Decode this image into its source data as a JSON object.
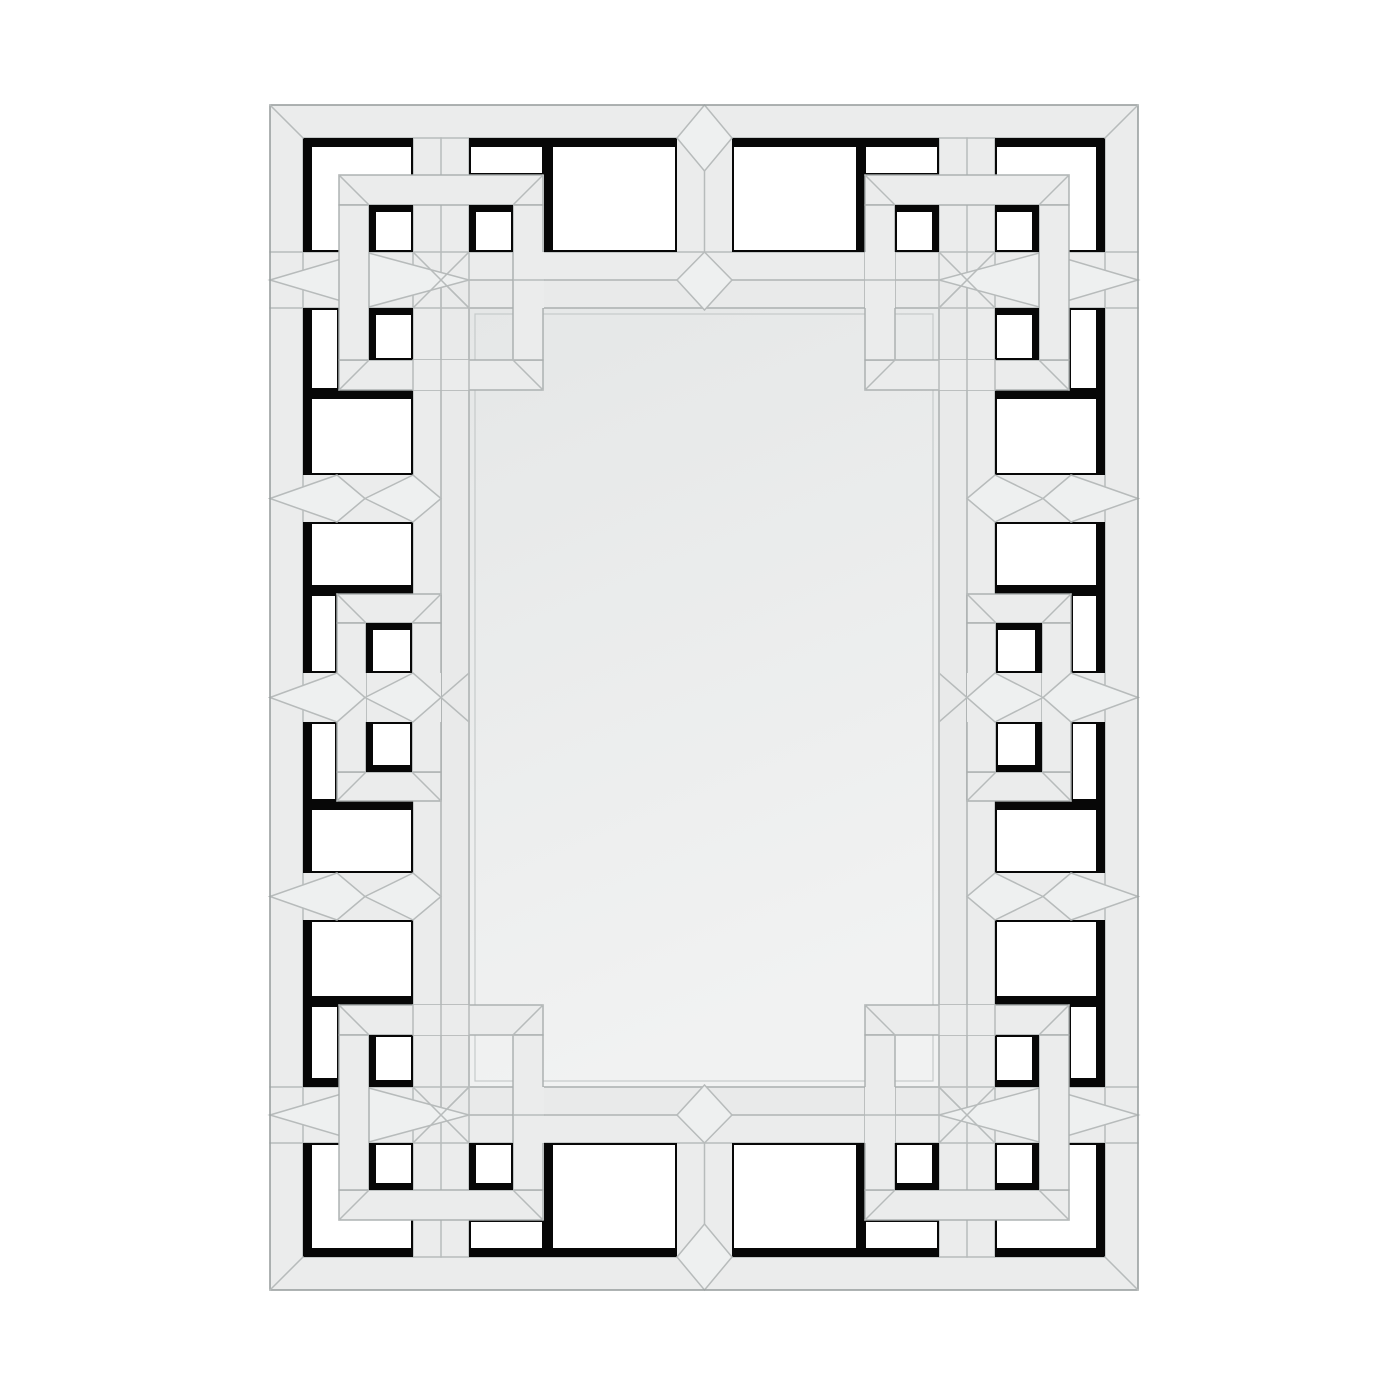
{
  "meta": {
    "image_type": "product-photo",
    "subject": "Rectangular wall mirror with interlocking Greek-key mirrored fretwork frame",
    "background": "plain white studio backdrop",
    "orientation": "portrait"
  },
  "colors": {
    "wall": "#ffffff",
    "panel": "#ebecec",
    "bevel_line": "#b7bbbb",
    "strip_edge": "#a8adad",
    "cutout_shadow": "#070707",
    "cutout_hole": "#ffffff",
    "glass_top": "#e5e7e7",
    "glass_bottom": "#f1f2f2",
    "glass_edge": "#8a8f8f",
    "panel_outline": "#9aa0a0"
  },
  "structure": {
    "pattern": "greek-key interlocking squares",
    "corner_rings": 4,
    "mid_side_rings": 2,
    "center_dividers": 2,
    "open_cutouts": 44,
    "center_glass": "beveled rectangular mirror",
    "panel_box": "270,105 to 1138,1290",
    "glass_box": "469,308 to 939,1087"
  }
}
